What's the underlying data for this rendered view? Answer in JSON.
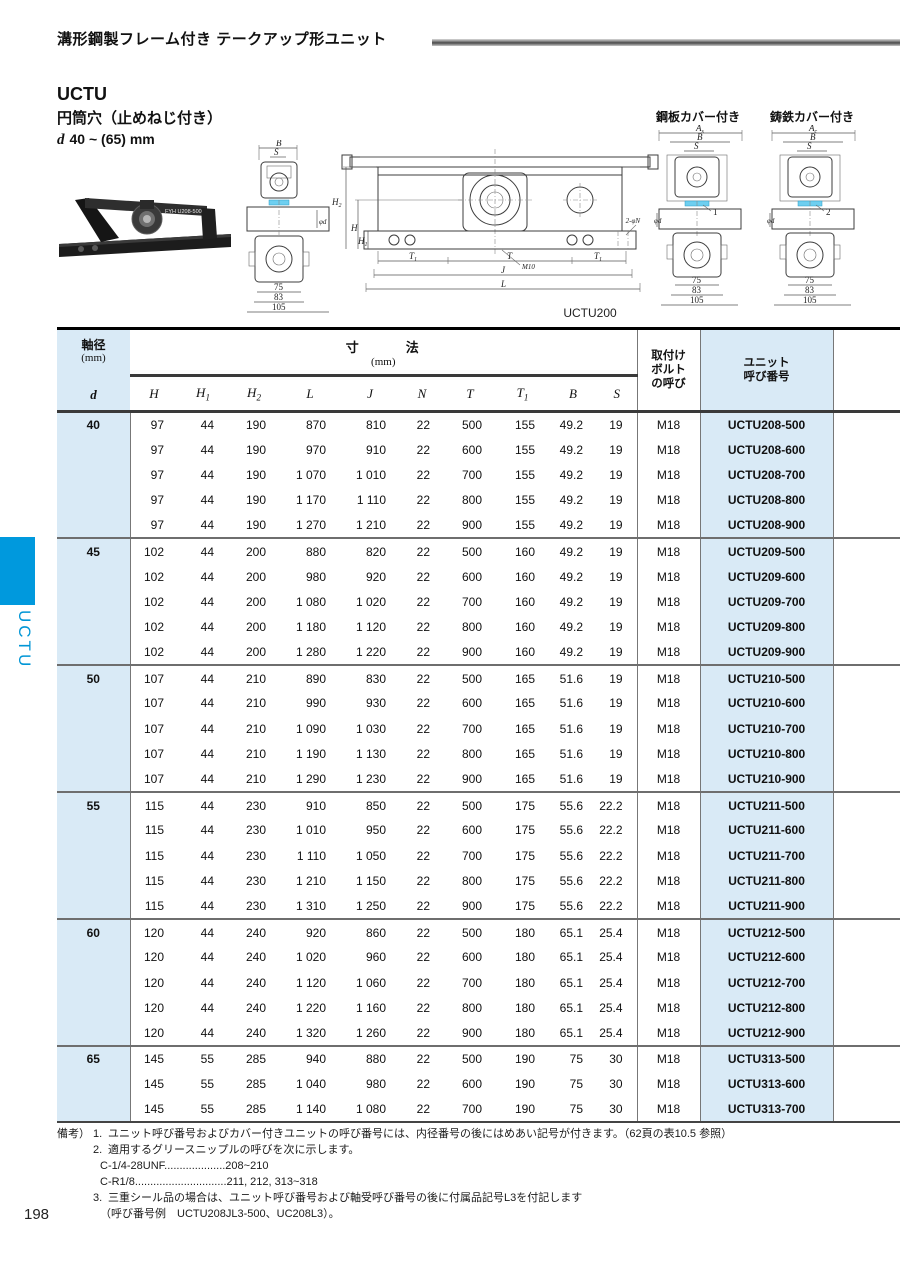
{
  "page": {
    "number": "198"
  },
  "header": {
    "title": "溝形鋼製フレーム付き テークアップ形ユニット"
  },
  "product": {
    "series": "UCTU",
    "bore_type": "円筒穴（止めねじ付き）",
    "d_symbol": "d",
    "d_range": "40 ~ (65) mm"
  },
  "covers": {
    "steel": "鋼板カバー付き",
    "cast": "鋳鉄カバー付き"
  },
  "sidebar": {
    "tab_label": "UCTU"
  },
  "drawings": {
    "caption": "UCTU200",
    "photo_label": "FYH U208-500",
    "labels": {
      "B": "B",
      "S": "S",
      "phid": "φd",
      "d75": "75",
      "d83": "83",
      "d105": "105",
      "Hb": "H",
      "H1b": "H",
      "H1s": "1",
      "H2b": "H",
      "H2s": "2",
      "T": "T",
      "T1b": "T",
      "T1s": "1",
      "J": "J",
      "L": "L",
      "M10": "M10",
      "N": "2-φN",
      "Asb": "A",
      "Ass": "s",
      "Acb": "A",
      "Acs": "c",
      "callout_steel": "1",
      "callout_cast": "2"
    }
  },
  "table": {
    "head": {
      "d_line1": "軸径",
      "d_line2": "(mm)",
      "d_line3": "d",
      "dim_group": "寸　　　法",
      "dim_unit": "(mm)",
      "dims": [
        [
          "H",
          ""
        ],
        [
          "H",
          "1"
        ],
        [
          "H",
          "2"
        ],
        [
          "L",
          ""
        ],
        [
          "J",
          ""
        ],
        [
          "N",
          ""
        ],
        [
          "T",
          ""
        ],
        [
          "T",
          "1"
        ],
        [
          "B",
          ""
        ],
        [
          "S",
          ""
        ]
      ],
      "bolt_lines": [
        "取付け",
        "ボルト",
        "の呼び"
      ],
      "unit_lines": [
        "ユニット",
        "呼び番号"
      ]
    },
    "groups": [
      {
        "d": "40",
        "rows": [
          [
            "97",
            "44",
            "190",
            "870",
            "810",
            "22",
            "500",
            "155",
            "49.2",
            "19",
            "M18",
            "UCTU208-500"
          ],
          [
            "97",
            "44",
            "190",
            "970",
            "910",
            "22",
            "600",
            "155",
            "49.2",
            "19",
            "M18",
            "UCTU208-600"
          ],
          [
            "97",
            "44",
            "190",
            "1 070",
            "1 010",
            "22",
            "700",
            "155",
            "49.2",
            "19",
            "M18",
            "UCTU208-700"
          ],
          [
            "97",
            "44",
            "190",
            "1 170",
            "1 110",
            "22",
            "800",
            "155",
            "49.2",
            "19",
            "M18",
            "UCTU208-800"
          ],
          [
            "97",
            "44",
            "190",
            "1 270",
            "1 210",
            "22",
            "900",
            "155",
            "49.2",
            "19",
            "M18",
            "UCTU208-900"
          ]
        ]
      },
      {
        "d": "45",
        "rows": [
          [
            "102",
            "44",
            "200",
            "880",
            "820",
            "22",
            "500",
            "160",
            "49.2",
            "19",
            "M18",
            "UCTU209-500"
          ],
          [
            "102",
            "44",
            "200",
            "980",
            "920",
            "22",
            "600",
            "160",
            "49.2",
            "19",
            "M18",
            "UCTU209-600"
          ],
          [
            "102",
            "44",
            "200",
            "1 080",
            "1 020",
            "22",
            "700",
            "160",
            "49.2",
            "19",
            "M18",
            "UCTU209-700"
          ],
          [
            "102",
            "44",
            "200",
            "1 180",
            "1 120",
            "22",
            "800",
            "160",
            "49.2",
            "19",
            "M18",
            "UCTU209-800"
          ],
          [
            "102",
            "44",
            "200",
            "1 280",
            "1 220",
            "22",
            "900",
            "160",
            "49.2",
            "19",
            "M18",
            "UCTU209-900"
          ]
        ]
      },
      {
        "d": "50",
        "rows": [
          [
            "107",
            "44",
            "210",
            "890",
            "830",
            "22",
            "500",
            "165",
            "51.6",
            "19",
            "M18",
            "UCTU210-500"
          ],
          [
            "107",
            "44",
            "210",
            "990",
            "930",
            "22",
            "600",
            "165",
            "51.6",
            "19",
            "M18",
            "UCTU210-600"
          ],
          [
            "107",
            "44",
            "210",
            "1 090",
            "1 030",
            "22",
            "700",
            "165",
            "51.6",
            "19",
            "M18",
            "UCTU210-700"
          ],
          [
            "107",
            "44",
            "210",
            "1 190",
            "1 130",
            "22",
            "800",
            "165",
            "51.6",
            "19",
            "M18",
            "UCTU210-800"
          ],
          [
            "107",
            "44",
            "210",
            "1 290",
            "1 230",
            "22",
            "900",
            "165",
            "51.6",
            "19",
            "M18",
            "UCTU210-900"
          ]
        ]
      },
      {
        "d": "55",
        "rows": [
          [
            "115",
            "44",
            "230",
            "910",
            "850",
            "22",
            "500",
            "175",
            "55.6",
            "22.2",
            "M18",
            "UCTU211-500"
          ],
          [
            "115",
            "44",
            "230",
            "1 010",
            "950",
            "22",
            "600",
            "175",
            "55.6",
            "22.2",
            "M18",
            "UCTU211-600"
          ],
          [
            "115",
            "44",
            "230",
            "1 110",
            "1 050",
            "22",
            "700",
            "175",
            "55.6",
            "22.2",
            "M18",
            "UCTU211-700"
          ],
          [
            "115",
            "44",
            "230",
            "1 210",
            "1 150",
            "22",
            "800",
            "175",
            "55.6",
            "22.2",
            "M18",
            "UCTU211-800"
          ],
          [
            "115",
            "44",
            "230",
            "1 310",
            "1 250",
            "22",
            "900",
            "175",
            "55.6",
            "22.2",
            "M18",
            "UCTU211-900"
          ]
        ]
      },
      {
        "d": "60",
        "rows": [
          [
            "120",
            "44",
            "240",
            "920",
            "860",
            "22",
            "500",
            "180",
            "65.1",
            "25.4",
            "M18",
            "UCTU212-500"
          ],
          [
            "120",
            "44",
            "240",
            "1 020",
            "960",
            "22",
            "600",
            "180",
            "65.1",
            "25.4",
            "M18",
            "UCTU212-600"
          ],
          [
            "120",
            "44",
            "240",
            "1 120",
            "1 060",
            "22",
            "700",
            "180",
            "65.1",
            "25.4",
            "M18",
            "UCTU212-700"
          ],
          [
            "120",
            "44",
            "240",
            "1 220",
            "1 160",
            "22",
            "800",
            "180",
            "65.1",
            "25.4",
            "M18",
            "UCTU212-800"
          ],
          [
            "120",
            "44",
            "240",
            "1 320",
            "1 260",
            "22",
            "900",
            "180",
            "65.1",
            "25.4",
            "M18",
            "UCTU212-900"
          ]
        ]
      },
      {
        "d": "65",
        "rows": [
          [
            "145",
            "55",
            "285",
            "940",
            "880",
            "22",
            "500",
            "190",
            "75",
            "30",
            "M18",
            "UCTU313-500"
          ],
          [
            "145",
            "55",
            "285",
            "1 040",
            "980",
            "22",
            "600",
            "190",
            "75",
            "30",
            "M18",
            "UCTU313-600"
          ],
          [
            "145",
            "55",
            "285",
            "1 140",
            "1 080",
            "22",
            "700",
            "190",
            "75",
            "30",
            "M18",
            "UCTU313-700"
          ]
        ]
      }
    ]
  },
  "notes": {
    "label": "備考）",
    "n1_no": "1.",
    "n1": "ユニット呼び番号およびカバー付きユニットの呼び番号には、内径番号の後にはめあい記号が付きます。（62頁の表10.5 参照）",
    "n2_no": "2.",
    "n2": "適用するグリースニップルの呼びを次に示します。",
    "n2a": "C-1/4-28UNF....................208~210",
    "n2b": "C-R1/8..............................211, 212, 313~318",
    "n3_no": "3.",
    "n3": "三重シール品の場合は、ユニット呼び番号および軸受呼び番号の後に付属品記号L3を付記します",
    "n3b": "（呼び番号例　UCTU208JL3-500、UC208L3）。"
  }
}
